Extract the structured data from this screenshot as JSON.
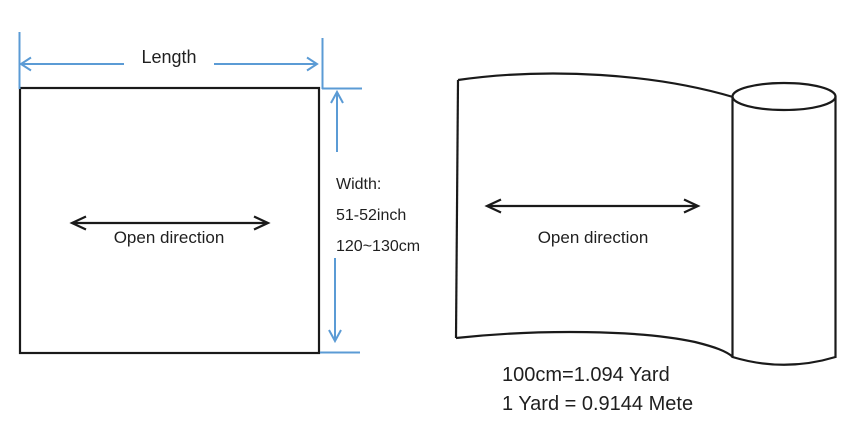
{
  "left_diagram": {
    "length_label": "Length",
    "width_spec": {
      "title": "Width:",
      "inches": "51-52inch",
      "centimeters": "120~130cm"
    },
    "open_direction_label": "Open direction"
  },
  "right_diagram": {
    "open_direction_label": "Open direction",
    "conversion_note": {
      "line1": "100cm=1.094 Yard",
      "line2": "1 Yard = 0.9144 Mete"
    }
  },
  "colors": {
    "dimension_blue": "#5B9BD5",
    "ink": "#1a1a1a"
  }
}
